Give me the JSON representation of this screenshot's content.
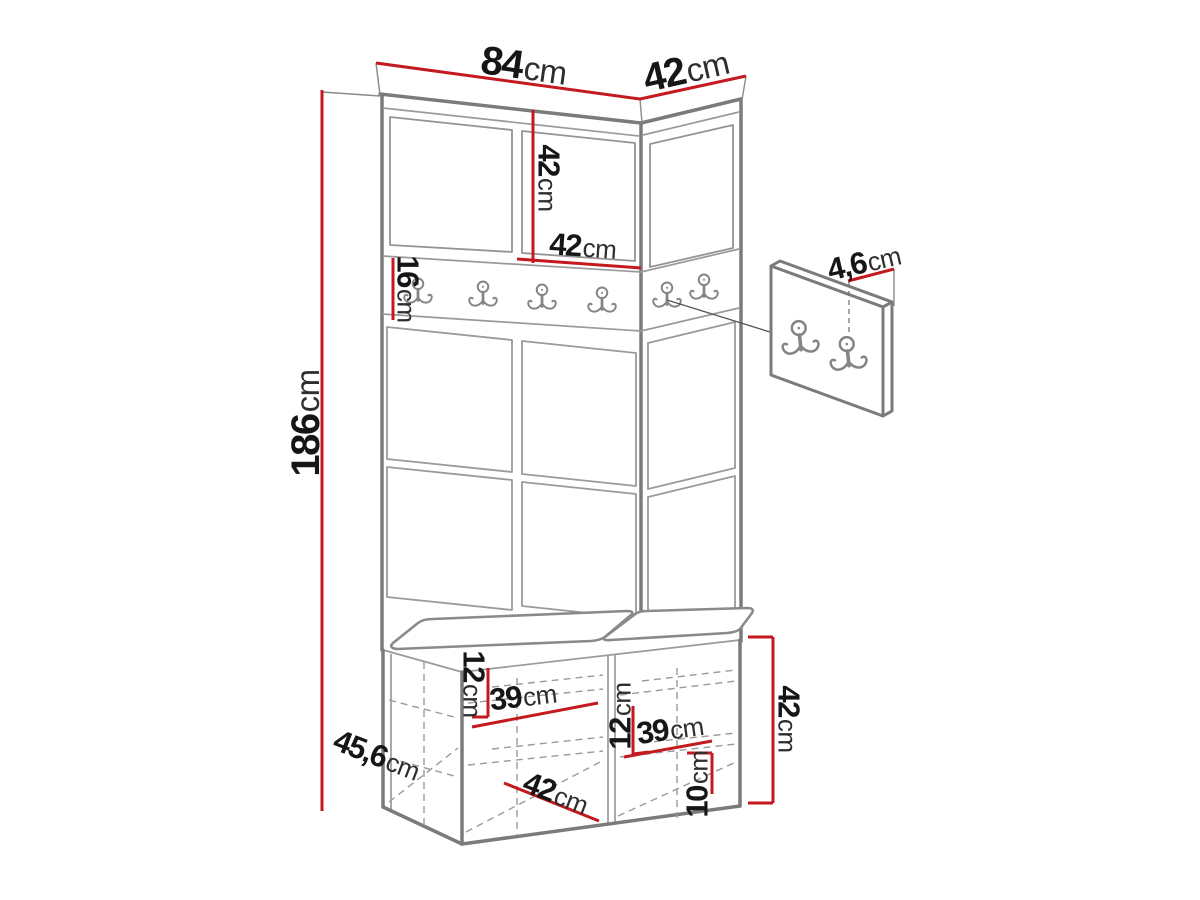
{
  "figure_type": "furniture-dimension-diagram",
  "dimensions": {
    "top_width": {
      "value": "84",
      "unit": "cm"
    },
    "top_depth": {
      "value": "42",
      "unit": "cm"
    },
    "cabinet_height": {
      "value": "42",
      "unit": "cm"
    },
    "cabinet_width": {
      "value": "42",
      "unit": "cm"
    },
    "rail_height": {
      "value": "16",
      "unit": "cm"
    },
    "total_height": {
      "value": "186",
      "unit": "cm"
    },
    "panel_thickness": {
      "value": "4,6",
      "unit": "cm"
    },
    "bench_left_shelf_height": {
      "value": "12",
      "unit": "cm"
    },
    "bench_left_shelf_width": {
      "value": "39",
      "unit": "cm"
    },
    "bench_depth": {
      "value": "45,6",
      "unit": "cm"
    },
    "bench_opening_width": {
      "value": "42",
      "unit": "cm"
    },
    "bench_right_shelf_height": {
      "value": "12",
      "unit": "cm"
    },
    "bench_right_shelf_width": {
      "value": "39",
      "unit": "cm"
    },
    "plinth_height": {
      "value": "10",
      "unit": "cm"
    },
    "bench_height": {
      "value": "42",
      "unit": "cm"
    }
  },
  "counts": {
    "rail_hooks": 6,
    "wall_panel_hooks": 2
  },
  "icons": {
    "hook": "double-coat-hook-icon"
  },
  "colors": {
    "dimension_line": "#c41a1f",
    "outline": "#7b7b7b",
    "detail_line": "#9a9a9a",
    "label_text": "#161616",
    "background": "#ffffff"
  }
}
